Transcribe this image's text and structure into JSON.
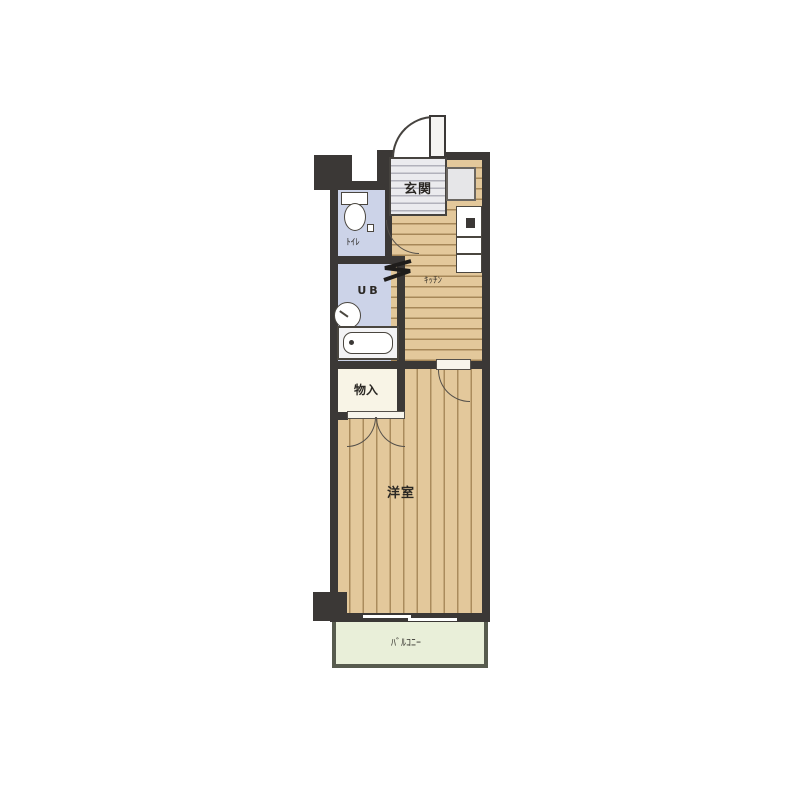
{
  "rooms": {
    "entrance": {
      "label": "玄関"
    },
    "toilet": {
      "label": "ﾄｲﾚ"
    },
    "unit_bath": {
      "label": "UB"
    },
    "kitchen": {
      "label": "ｷｯﾁﾝ"
    },
    "storage": {
      "label": "物入"
    },
    "western_room": {
      "label": "洋室"
    },
    "balcony": {
      "label": "ﾊﾞﾙｺﾆｰ"
    }
  },
  "colors": {
    "wall": "#3b3836",
    "wet_area_floor": "#ccd3e8",
    "wood_floor": "#e3c89b",
    "storage_floor": "#f8f4e6",
    "entrance_floor": "#ebebee",
    "balcony_floor": "#e9efd9",
    "background": "#ffffff"
  }
}
